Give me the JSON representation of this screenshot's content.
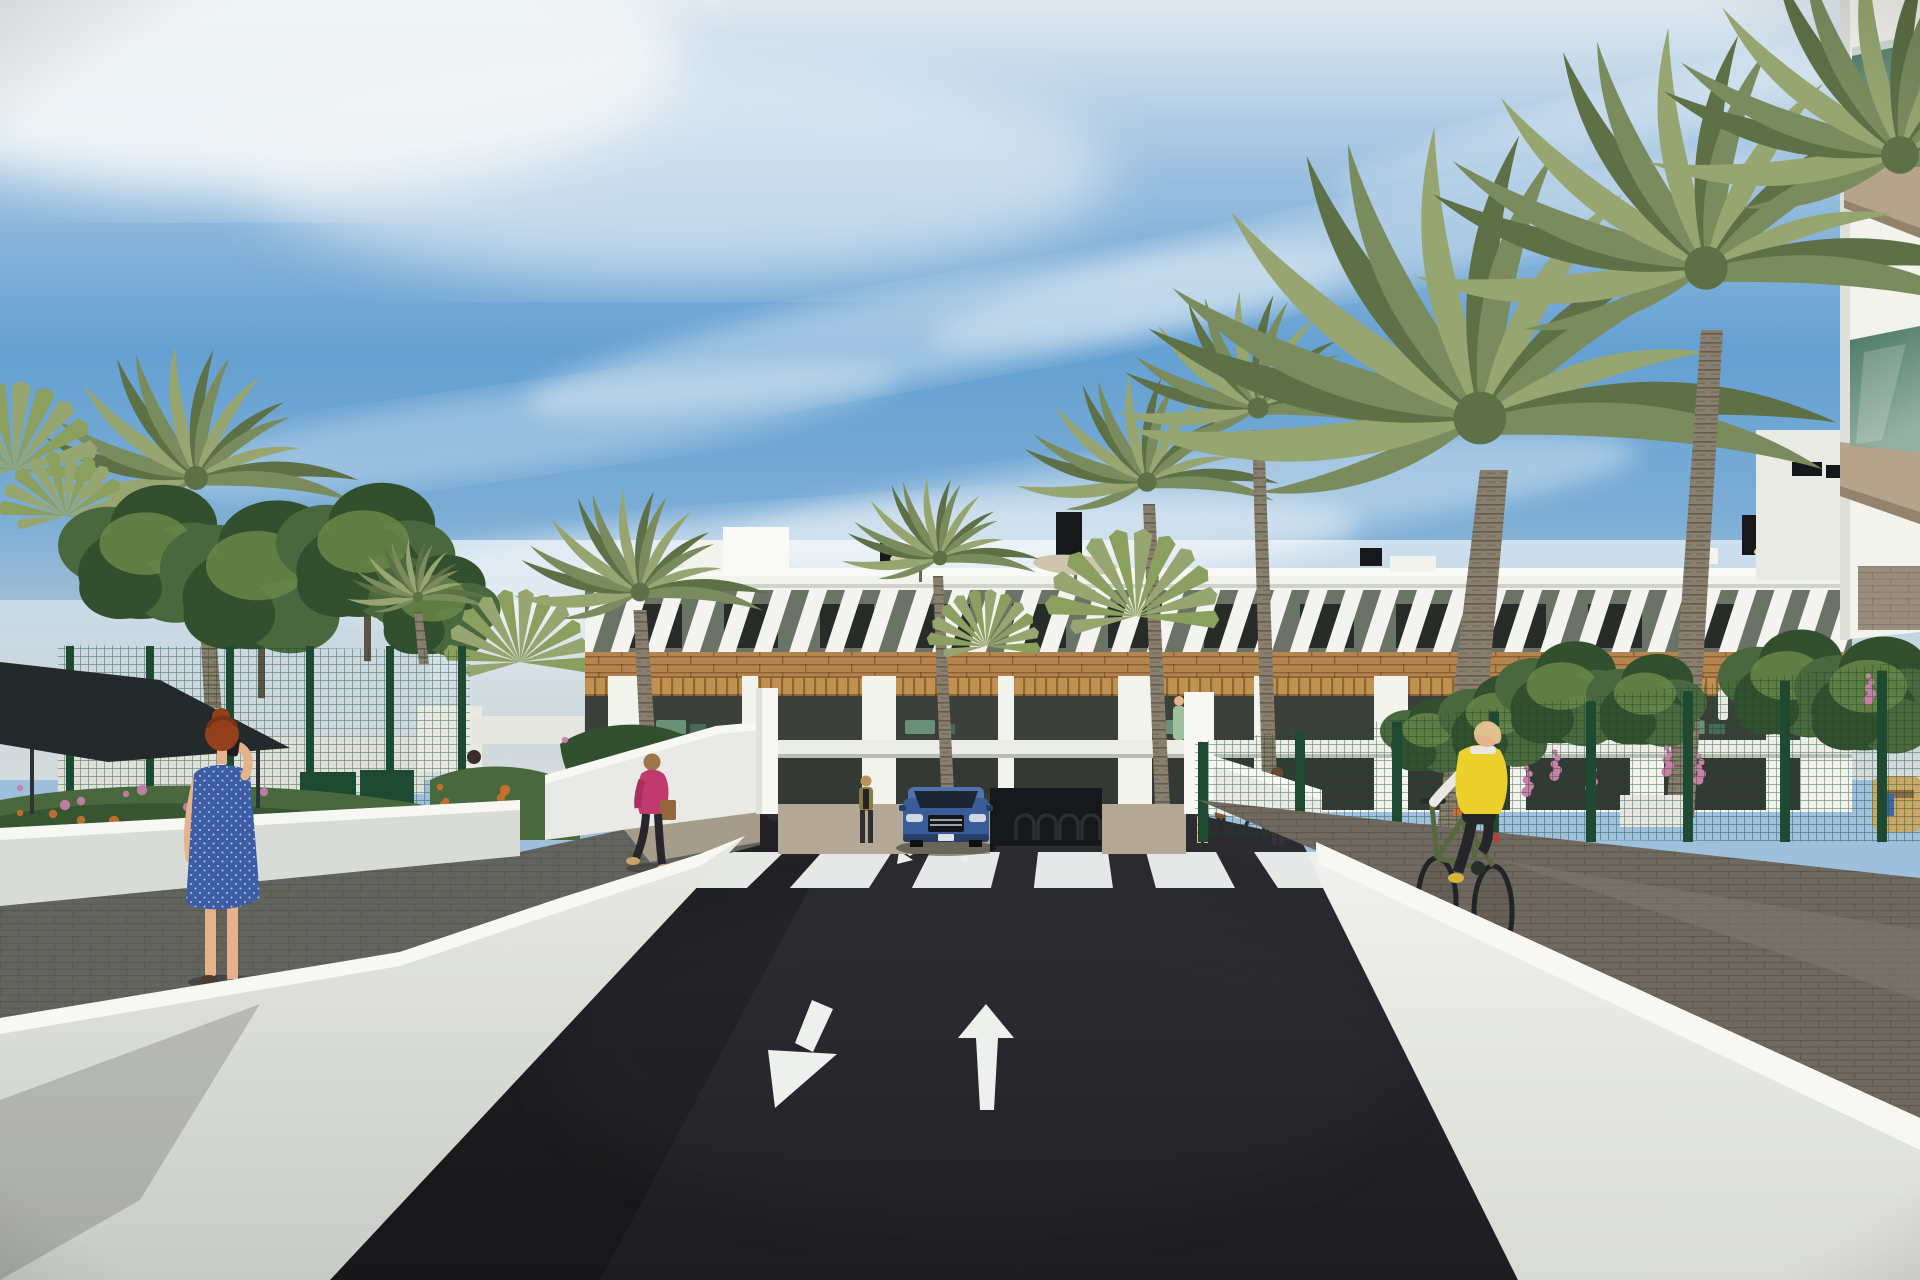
{
  "scene": {
    "title": "Residential complex exterior render",
    "description": "Sunny 3D architectural visualization: modern white three-storey apartment building with wood-slat accents and louvered top floor, palm trees and gardens, a dark asphalt access road with a zebra crosswalk and two white lane arrows, a blue SUV at a garage entrance, pedestrians, and a cyclist in a yellow vest on a paved path behind a white wall."
  },
  "road_markings": {
    "crosswalk_stripe_count": 7,
    "left_lane_arrow": "diagonal arrow pointing down-left",
    "right_lane_arrow": "straight arrow pointing up",
    "small_ramp_arrows": [
      "down arrow",
      "up arrow"
    ]
  },
  "elements": [
    {
      "name": "sky",
      "label": "blue sky with wispy clouds"
    },
    {
      "name": "background-building",
      "label": "white apartment block with louvered top floor, wood band and balconies"
    },
    {
      "name": "rooftop",
      "label": "roof boxes, chimneys and parasols"
    },
    {
      "name": "corner-building",
      "label": "foreground building corner with green glass balconies"
    },
    {
      "name": "palms",
      "label": "date palms and fan palms"
    },
    {
      "name": "green-fence",
      "label": "dark green mesh garden fence"
    },
    {
      "name": "shade-sail",
      "label": "dark shade canopy on the left"
    },
    {
      "name": "road",
      "label": "dark asphalt road with white markings"
    },
    {
      "name": "car",
      "label": "blue SUV facing viewer"
    },
    {
      "name": "woman-blue-dress",
      "label": "red-haired woman in blue dress on phone"
    },
    {
      "name": "woman-pink-jacket",
      "label": "woman in pink jacket with handbag"
    },
    {
      "name": "man-white-shirt",
      "label": "man in white t-shirt"
    },
    {
      "name": "cyclist",
      "label": "cyclist in yellow vest on green bicycle"
    },
    {
      "name": "pedestrians-entrance",
      "label": "residents near entrance and bike racks"
    }
  ],
  "palette": {
    "sky_top": "#e0e9f0",
    "sky_mid": "#64a0d2",
    "sky_low": "#7badd6",
    "sky_haze": "#c6d2d8",
    "cloud": "#f2f6f8",
    "building_white": "#f3f3ee",
    "parapet": "#f9f9f5",
    "building_shade": "#dadcd4",
    "louver_bg": "#6b7266",
    "window_dark": "#272c28",
    "wood": "#b5854f",
    "pergola": "#c0914f",
    "recess": "#3b403a",
    "rail": "#ecede7",
    "ground_glass": "#343a33",
    "garage": "#17181b",
    "wall_white": "#e9eae5",
    "wall_bright": "#f7f7f3",
    "road": "#242428",
    "marking": "#eef0ee",
    "paver_right": "#6f695f",
    "paver_left": "#63645e",
    "walkway_tan": "#b3a795",
    "fence_green": "#245236",
    "gate_green": "#1d4a31",
    "foliage_dark": "#33502e",
    "foliage_mid": "#49683d",
    "foliage_light": "#6c8a4a",
    "palm_green": "#7a8c5e",
    "palm_light": "#97a671",
    "palm_dark": "#5d7046",
    "fan_green": "#8ba05e",
    "trunk": "#897f6e",
    "canopy": "#24292b",
    "car_body": "#3a5d99",
    "car_roof": "#4f74ab",
    "car_dark": "#273f66",
    "car_glass": "#1d2630",
    "glass_dark": "#41705f",
    "glass_light": "#8fae9f",
    "underside_tan": "#b5a48b",
    "skin": "#e6b28c",
    "dress_blue": "#3c5ca4",
    "hair_red": "#933f1c",
    "jacket_pink": "#c03a6e",
    "bag_brown": "#96673c",
    "vest_yellow": "#ecd02c",
    "legging_dark": "#26262a",
    "hair_blonde": "#ddc28f",
    "shirt_white": "#ecece8",
    "flower_pink": "#c87fa8",
    "flower_orange": "#c9712d"
  }
}
